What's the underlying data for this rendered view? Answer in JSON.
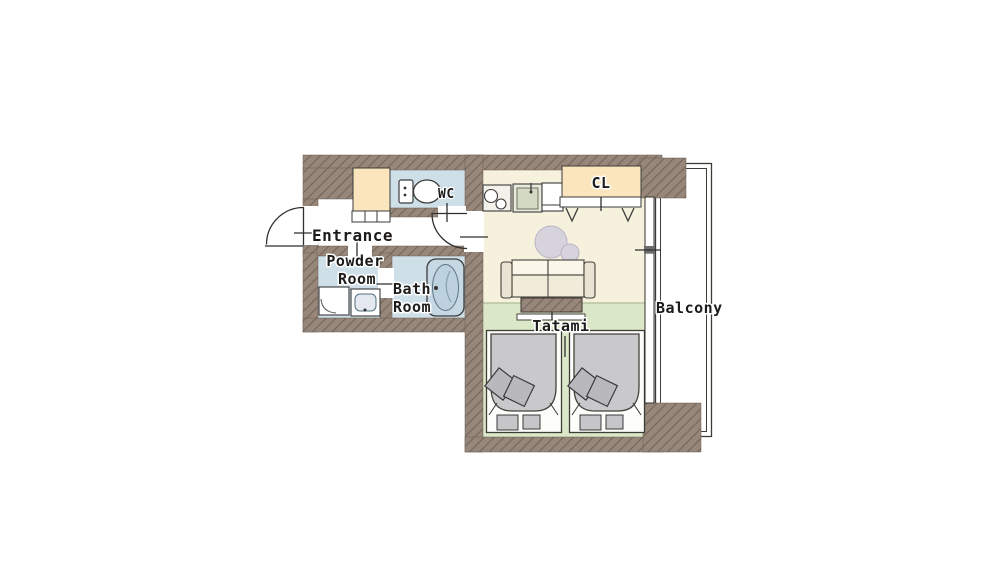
{
  "floor_plan": {
    "rooms": [
      {
        "id": "entrance",
        "lines": [
          "Entrance"
        ]
      },
      {
        "id": "powder-room",
        "lines": [
          "Powder",
          "Room"
        ]
      },
      {
        "id": "bath-room",
        "lines": [
          "Bath",
          "Room"
        ]
      },
      {
        "id": "wc",
        "lines": [
          "WC"
        ]
      },
      {
        "id": "closet",
        "lines": [
          "CL"
        ]
      },
      {
        "id": "tatami",
        "lines": [
          "Tatami"
        ]
      },
      {
        "id": "balcony",
        "lines": [
          "Balcony"
        ]
      }
    ],
    "colors": {
      "wall": "#97877a",
      "hatch": "#77675c",
      "floor": "#f6f1dd",
      "tatami": "#dbe8c8",
      "wet": "#cfdfe8",
      "cabinet": "#fbe5bc",
      "bed": "#c9c9cb",
      "pillow": "#b9b9bd",
      "pouf": "#d7d3dd",
      "balcony": "#ffffff"
    },
    "fixtures": [
      "toilet",
      "bathtub",
      "vanity-sink",
      "washer",
      "kitchen-stove",
      "kitchen-sink",
      "counter",
      "shoe-cabinet",
      "sofa",
      "low-table",
      "round-pouf",
      "hanger",
      "single-bed",
      "pillow",
      "floor-cushion",
      "door-swing",
      "sliding-window",
      "railing"
    ]
  }
}
